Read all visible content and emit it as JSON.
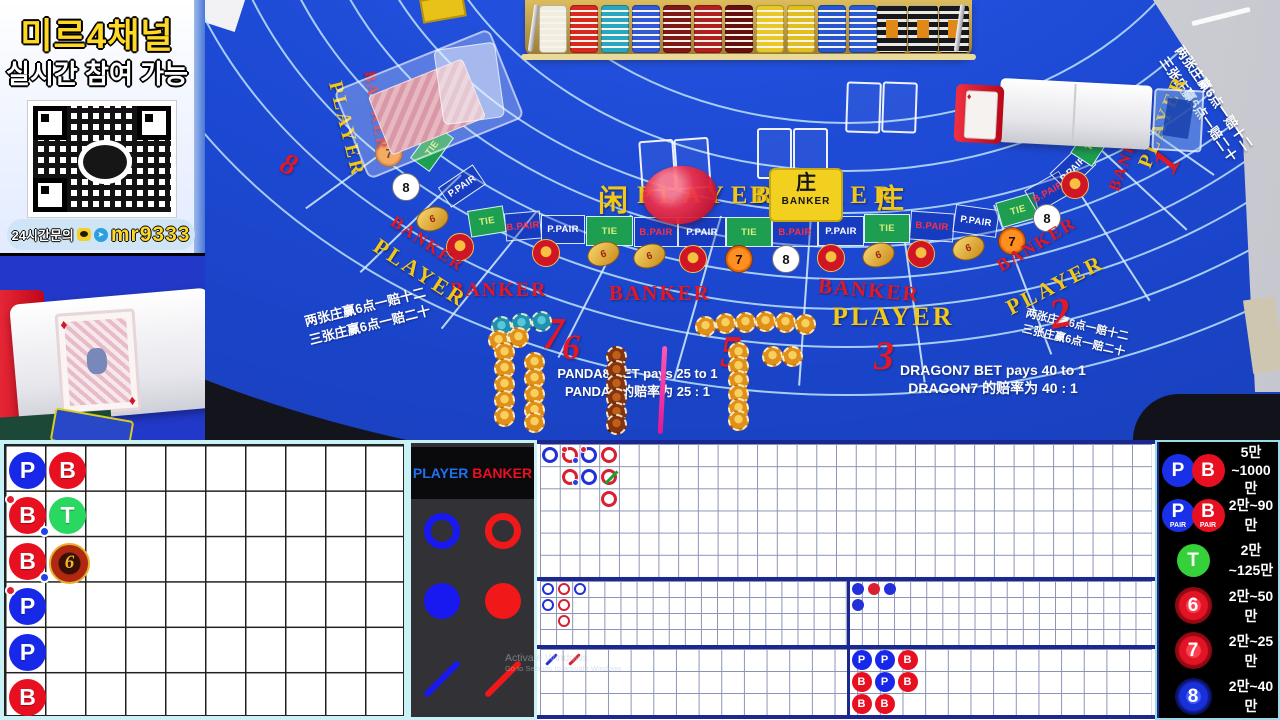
{
  "colors": {
    "felt": "#1b46cf",
    "player_blue": "#1828e8",
    "banker_red": "#e81020",
    "tie_green": "#28d860",
    "gold": "#e8b032",
    "accent_cyan": "#bfeef2"
  },
  "promo": {
    "title": "미르4채널",
    "subtitle": "실시간 참여 가능",
    "contact_label": "24시간문의",
    "contact_id": "mr9333"
  },
  "table": {
    "player_cn": "闲",
    "player_label": "PLAYER",
    "banker_label": "BANKER",
    "banker_cn": "庄",
    "plaque": {
      "cn": "庄",
      "en": "BANKER"
    },
    "ring_cells": [
      "TIE",
      "B.PAIR",
      "P.PAIR",
      "TIE",
      "B.PAIR",
      "P.PAIR",
      "TIE",
      "B.PAIR",
      "P.PAIR",
      "TIE",
      "B.PAIR",
      "P.PAIR"
    ],
    "arc_cells_left": [
      "TIE",
      "P.PAIR"
    ],
    "arc_cells_right": [
      "TIE",
      "B.PAIR",
      "P.PAIR",
      "TIE"
    ],
    "badges": [
      "dragon",
      "lucky6",
      "lucky6",
      "dragon",
      "seven",
      "panda",
      "dragon",
      "lucky6",
      "dragon",
      "lucky6",
      "seven",
      "panda",
      "dragon",
      "seven",
      "panda",
      "lucky6",
      "dragon"
    ],
    "badge_glyphs": {
      "seven": "7",
      "panda": "8",
      "lucky6": "6",
      "dragon": ""
    },
    "seats": [
      "8",
      "7",
      "6",
      "5",
      "3",
      "2",
      "1"
    ],
    "panda8_lines": [
      "PANDA8 BET pays 25 to 1",
      "PANDA8 的赔率为 25 : 1"
    ],
    "dragon7_lines": [
      "DRAGON7 BET pays 40 to 1",
      "DRAGON7 的赔率为 40 : 1"
    ],
    "lucky6_rules": [
      "两张庄赢6点一赔十二",
      "三张庄赢6点一赔二十"
    ]
  },
  "legend": {
    "player": "PLAYER",
    "banker": "BANKER"
  },
  "scoreboards": {
    "letters": {
      "P": "P",
      "B": "B",
      "T": "T",
      "L6": "6"
    },
    "beadplate": {
      "rows": 6,
      "cols": 10,
      "entries": [
        {
          "r": 1,
          "c": 1,
          "t": "P"
        },
        {
          "r": 2,
          "c": 1,
          "t": "B",
          "bp": true,
          "pp": true
        },
        {
          "r": 3,
          "c": 1,
          "t": "B",
          "pp": true
        },
        {
          "r": 4,
          "c": 1,
          "t": "P",
          "bp": true
        },
        {
          "r": 5,
          "c": 1,
          "t": "P"
        },
        {
          "r": 6,
          "c": 1,
          "t": "B"
        },
        {
          "r": 1,
          "c": 2,
          "t": "B"
        },
        {
          "r": 2,
          "c": 2,
          "t": "T"
        },
        {
          "r": 3,
          "c": 2,
          "t": "L6"
        }
      ]
    },
    "bigroad": {
      "rows": 6,
      "cols": 31,
      "entries": [
        {
          "c": 1,
          "r": 1,
          "t": "P"
        },
        {
          "c": 2,
          "r": 1,
          "t": "B",
          "bp": true,
          "pp": true
        },
        {
          "c": 2,
          "r": 2,
          "t": "B",
          "pp": true
        },
        {
          "c": 3,
          "r": 1,
          "t": "P",
          "bp": true
        },
        {
          "c": 3,
          "r": 2,
          "t": "P"
        },
        {
          "c": 4,
          "r": 1,
          "t": "B"
        },
        {
          "c": 4,
          "r": 2,
          "t": "B",
          "tie": true
        },
        {
          "c": 4,
          "r": 3,
          "t": "B"
        }
      ]
    },
    "bigeye": {
      "entries": [
        {
          "c": 1,
          "r": 1,
          "t": "P"
        },
        {
          "c": 2,
          "r": 1,
          "t": "B"
        },
        {
          "c": 3,
          "r": 1,
          "t": "P"
        },
        {
          "c": 1,
          "r": 2,
          "t": "P"
        },
        {
          "c": 2,
          "r": 2,
          "t": "B"
        },
        {
          "c": 2,
          "r": 3,
          "t": "B"
        }
      ]
    },
    "smallroad": {
      "entries": [
        {
          "c": 1,
          "r": 1,
          "t": "P"
        },
        {
          "c": 2,
          "r": 1,
          "t": "B"
        },
        {
          "c": 3,
          "r": 1,
          "t": "P"
        },
        {
          "c": 1,
          "r": 2,
          "t": "P"
        }
      ]
    },
    "cockroach": {
      "entries": [
        {
          "c": 1,
          "r": 1,
          "t": "P"
        },
        {
          "c": 2,
          "r": 1,
          "t": "B"
        }
      ]
    },
    "minibead": {
      "entries": [
        {
          "c": 1,
          "r": 1,
          "t": "P"
        },
        {
          "c": 2,
          "r": 1,
          "t": "P"
        },
        {
          "c": 3,
          "r": 1,
          "t": "B"
        },
        {
          "c": 1,
          "r": 2,
          "t": "B"
        },
        {
          "c": 2,
          "r": 2,
          "t": "P"
        },
        {
          "c": 3,
          "r": 2,
          "t": "B"
        },
        {
          "c": 1,
          "r": 3,
          "t": "B"
        },
        {
          "c": 2,
          "r": 3,
          "t": "B"
        }
      ]
    }
  },
  "limits": {
    "rows": [
      {
        "icons": [
          {
            "t": "P",
            "style": "blue"
          },
          {
            "t": "B",
            "style": "red"
          }
        ],
        "range": "5만~1000만"
      },
      {
        "icons": [
          {
            "t": "P",
            "sub": "PAIR",
            "style": "blue"
          },
          {
            "t": "B",
            "sub": "PAIR",
            "style": "red"
          }
        ],
        "range": "2만~90만"
      },
      {
        "icons": [
          {
            "t": "T",
            "style": "green"
          }
        ],
        "range": "2만~125만"
      },
      {
        "icons": [
          {
            "t": "6",
            "style": "coin-red"
          }
        ],
        "range": "2만~50만"
      },
      {
        "icons": [
          {
            "t": "7",
            "style": "coin-red"
          }
        ],
        "range": "2만~25만"
      },
      {
        "icons": [
          {
            "t": "8",
            "style": "coin-blue"
          }
        ],
        "range": "2만~40만"
      }
    ]
  },
  "watermark": {
    "line1": "Activate Windows",
    "line2": "Go to Settings to activate Windows."
  }
}
